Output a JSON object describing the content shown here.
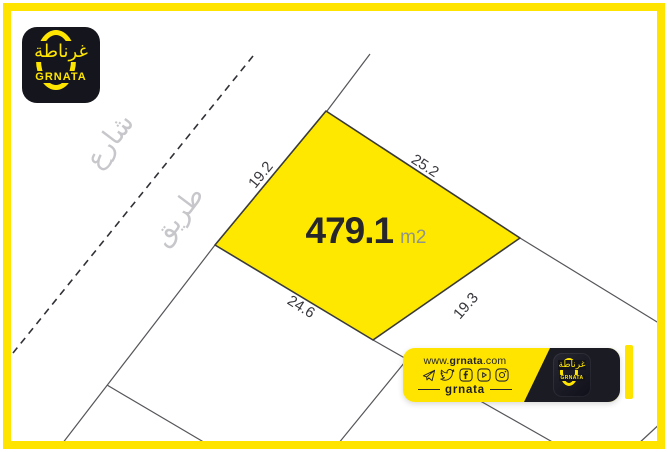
{
  "brand": {
    "name_arabic": "غرناطة",
    "name_latin": "GRNATA"
  },
  "map": {
    "street_label": "شارع",
    "road_label": "طريق",
    "plot": {
      "area_value": "479.1",
      "area_unit": "m2",
      "dimensions": {
        "top_left": "19.2",
        "top_right": "25.2",
        "bottom_left": "24.6",
        "bottom_right": "19.3"
      }
    }
  },
  "footer_banner": {
    "website": {
      "prefix": "www.",
      "name": "grnata",
      "suffix": ".com"
    },
    "social_icons": [
      "telegram-icon",
      "twitter-icon",
      "facebook-icon",
      "youtube-icon",
      "instagram-icon"
    ],
    "handle": "grnata"
  },
  "colors": {
    "brand_yellow": "#FFE400",
    "plot_yellow": "#FFE800",
    "logo_black": "#15151D",
    "banner_black": "#1B1B24",
    "road_gray": "#C7C7CB",
    "dim_dark": "#38383E"
  }
}
